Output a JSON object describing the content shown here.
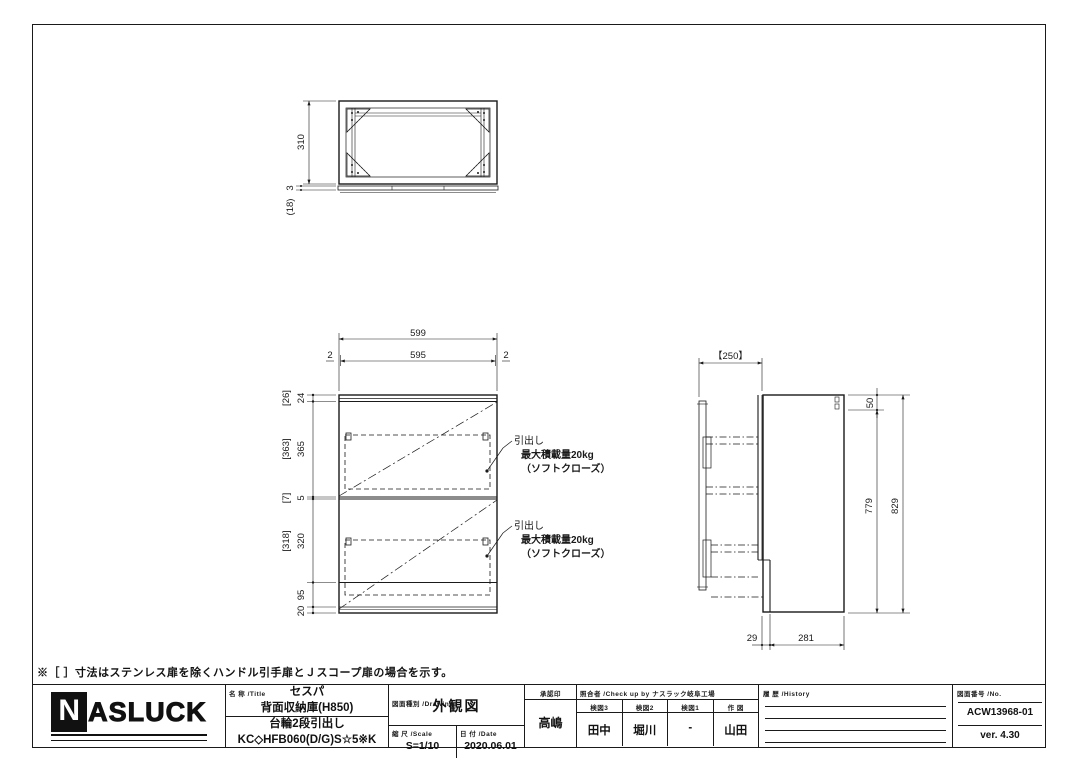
{
  "sheet": {
    "note": "※［ ］寸法はステンレス扉を除くハンドル引手扉とＪスコープ扉の場合を示す。"
  },
  "views": {
    "top": {
      "h310": "310",
      "t3": "3",
      "t18": "(18)"
    },
    "front": {
      "w599": "599",
      "w2l": "2",
      "w595": "595",
      "w2r": "2",
      "left_dims": [
        [
          "[26]",
          "24"
        ],
        [
          "[363]",
          "365"
        ],
        [
          "[7]",
          "5"
        ],
        [
          "[318]",
          "320"
        ],
        [
          "",
          "95"
        ],
        [
          "",
          "20"
        ]
      ],
      "annotations": [
        {
          "l1": "引出し",
          "l2": "最大積載量20kg",
          "l3": "（ソフトクローズ）"
        },
        {
          "l1": "引出し",
          "l2": "最大積載量20kg",
          "l3": "（ソフトクローズ）"
        }
      ]
    },
    "side": {
      "depth": "【250】",
      "top50": "50",
      "h779": "779",
      "h829": "829",
      "d29": "29",
      "d281": "281"
    }
  },
  "titleblock": {
    "logo": {
      "n": "N",
      "rest": "ASLUCK"
    },
    "title": {
      "label": "名 称 /Title",
      "line1": "セスパ",
      "line2": "背面収納庫(H850)",
      "line3": "台輪2段引出し",
      "line4": "KC◇HFB060(D/G)S☆5※K"
    },
    "drawing": {
      "label": "図面種別 /Drawing",
      "value": "外観図"
    },
    "scale": {
      "label": "縮 尺 /Scale",
      "value": "S=1/10"
    },
    "date": {
      "label": "日 付 /Date",
      "value": "2020.06.01"
    },
    "approval": {
      "label": "承認印",
      "value": "高嶋"
    },
    "check": {
      "label": "照合者 /Check up by ナスラック岐阜工場",
      "cols": [
        {
          "h": "検図3",
          "v": "田中"
        },
        {
          "h": "検図2",
          "v": "堀川"
        },
        {
          "h": "検図1",
          "v": "-"
        },
        {
          "h": "作 図",
          "v": "山田"
        }
      ]
    },
    "history": {
      "label": "履 歴 /History"
    },
    "number": {
      "label": "図面番号 /No.",
      "value": "ACW13968-01",
      "version": "ver. 4.30"
    }
  }
}
